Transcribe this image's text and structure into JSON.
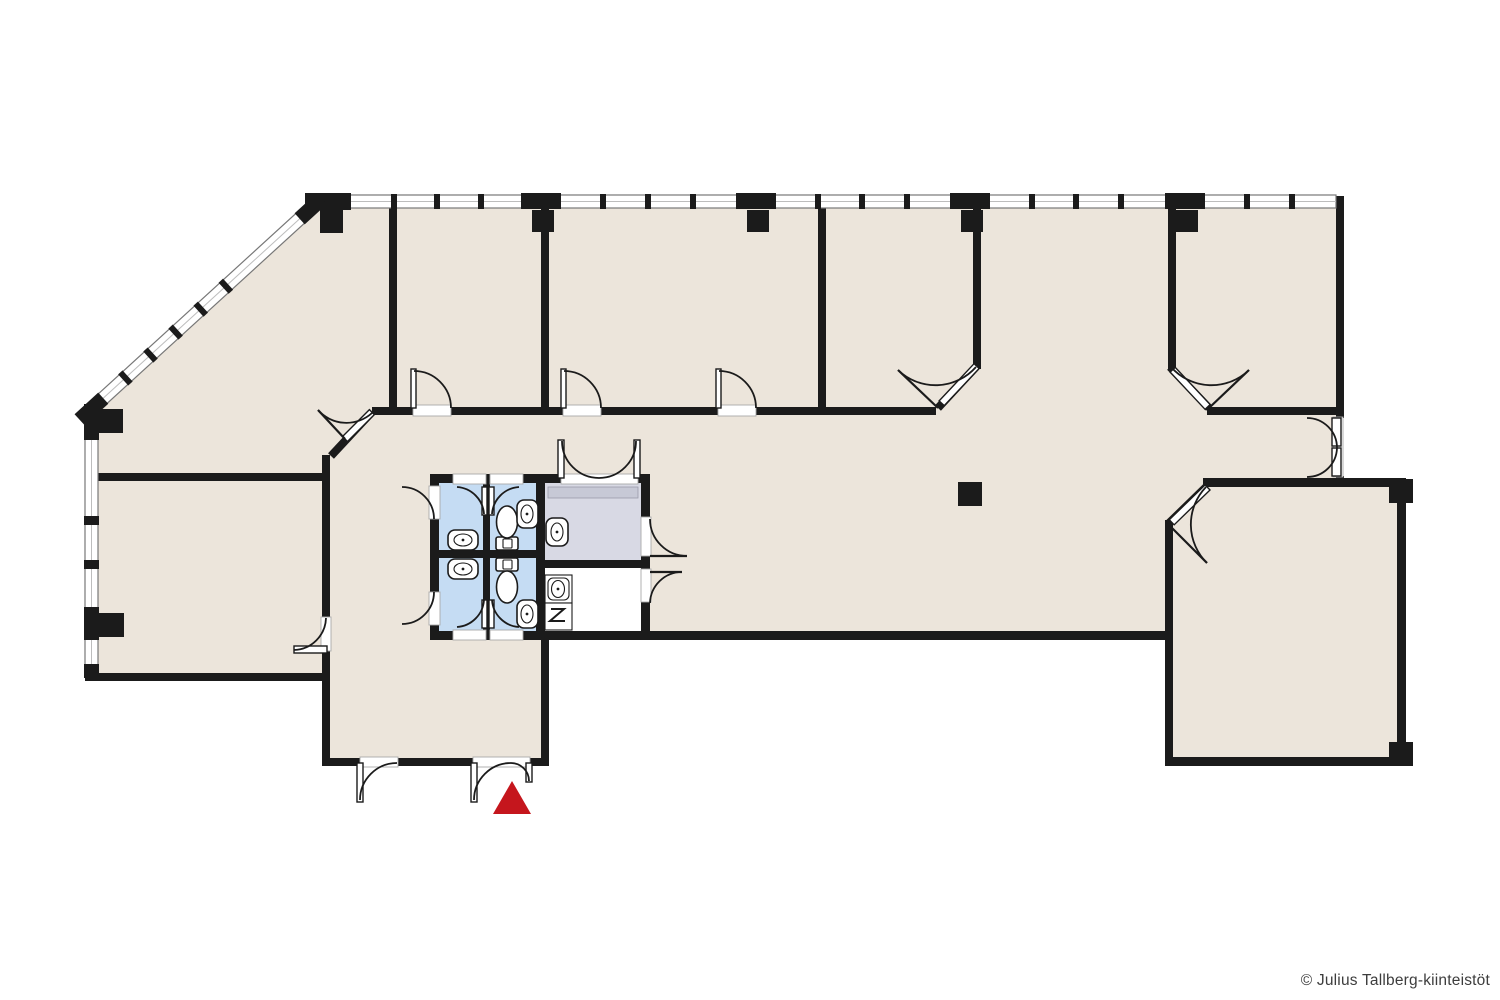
{
  "copyright": {
    "text": "© Julius Tallberg-kiinteistöt"
  },
  "colors": {
    "background": "#ffffff",
    "floor": "#ece5db",
    "wall": "#1b1b1b",
    "wc_blue": "#c5dcf3",
    "service_gray": "#d8d9e4",
    "threshold_band": "#c7c9d6",
    "window_line": "#777777",
    "window_fill": "#ffffff",
    "entrance_red": "#c5161d",
    "copyright_text": "#3d3d3d"
  },
  "plan": {
    "type": "office-floor-plan",
    "entrance_marker": "red-triangle-at-main-entrance-doors",
    "wet_rooms": "blue-wc-block-with-toilets-and-sinks",
    "service_rooms": "gray-room-and-white-utility-room-with-electrical-symbol"
  }
}
